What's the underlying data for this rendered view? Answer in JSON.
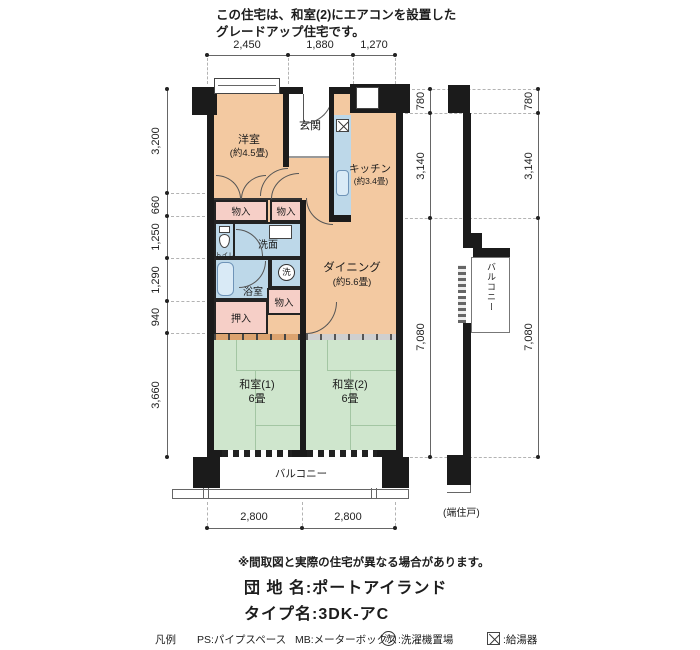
{
  "header": {
    "line1": "この住宅は、和室(2)にエアコンを設置した",
    "line2": "グレードアップ住宅です。"
  },
  "dimensions": {
    "top": [
      "2,450",
      "1,880",
      "1,270"
    ],
    "left": [
      "3,200",
      "660",
      "1,250",
      "1,290",
      "940",
      "3,660"
    ],
    "right_inner": [
      "780",
      "3,140",
      "7,080"
    ],
    "right_outer": [
      "780",
      "3,140",
      "7,080"
    ],
    "bottom": [
      "2,800",
      "2,800"
    ]
  },
  "rooms": {
    "yoshitsu": {
      "name": "洋室",
      "size": "(約4.5畳)"
    },
    "genkan": {
      "name": "玄関"
    },
    "kitchen": {
      "name": "キッチン",
      "size": "(約3.4畳)"
    },
    "dining": {
      "name": "ダイニング",
      "size": "(約5.6畳)"
    },
    "washitsu1": {
      "name": "和室(1)",
      "size": "6畳"
    },
    "washitsu2": {
      "name": "和室(2)",
      "size": "6畳"
    },
    "monoire1": {
      "name": "物入"
    },
    "monoire2": {
      "name": "物入"
    },
    "monoire3": {
      "name": "物入"
    },
    "oshiire": {
      "name": "押入"
    },
    "toilet": {
      "name": "トイレ"
    },
    "senmen": {
      "name": "洗面"
    },
    "yokushitsu": {
      "name": "浴室"
    },
    "laundry_symbol": "洗",
    "balcony_bottom": {
      "name": "バルコニー"
    },
    "balcony_side": {
      "name": "バルコニー"
    },
    "end_unit_note": "(端住戸)"
  },
  "footer": {
    "note": "※間取図と実際の住宅が異なる場合があります。",
    "danchi_label": "団 地 名:ポートアイランド",
    "type_label": "タイプ名:3DK-アC"
  },
  "legend": {
    "title": "凡例",
    "ps": "PS:パイプスペース",
    "mb": "MB:メーターボックス",
    "laundry_symbol": "洗",
    "laundry_text": ":洗濯機置場",
    "heater_text": ":給湯器"
  },
  "colors": {
    "room_peach": "#f3c9a1",
    "room_pink": "#f6cfc7",
    "room_blue": "#bdd8e9",
    "room_green": "#cfe6cd",
    "wall": "#1b1b1b"
  }
}
